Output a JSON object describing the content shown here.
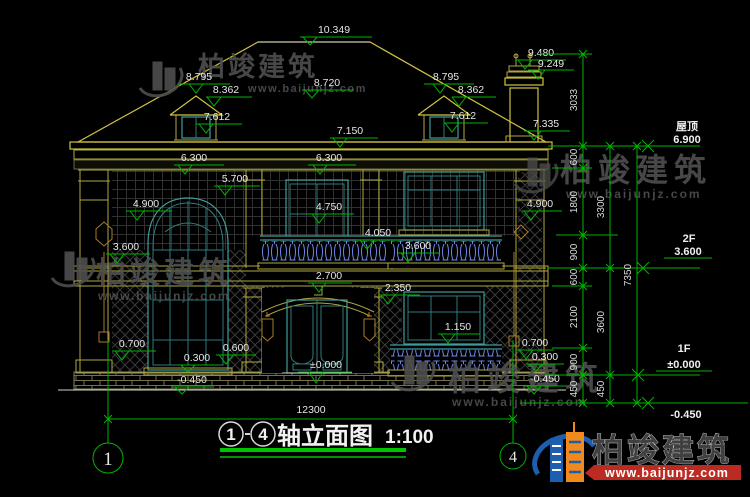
{
  "drawing": {
    "title": "轴立面图",
    "scale": "1:100",
    "axis_start": "1",
    "axis_end": "4"
  },
  "levels": {
    "roof_label": "屋顶",
    "roof_value": "6.900",
    "f2_label": "2F",
    "f2_value": "3.600",
    "f1_label": "1F",
    "f1_value": "±0.000",
    "below_ground": "-0.450"
  },
  "dims": {
    "roof_ridge": "10.349",
    "roof_mid": "8.720",
    "dormer_l_top": "8.795",
    "dormer_l_eave": "8.362",
    "dormer_l_sill": "7.612",
    "dormer_r_top": "8.795",
    "dormer_r_eave": "8.362",
    "dormer_r_sill": "7.612",
    "eave_mid": "7.150",
    "chimney_top": "9.480",
    "chimney_cap": "9.249",
    "chimney_eave": "7.335",
    "band_left": "6.300",
    "band_right": "6.300",
    "arch_top": "5.700",
    "left_head": "4.900",
    "right_head": "4.900",
    "f2_sill": "4.750",
    "balcony_rail": "4.050",
    "balcony_floor": "3.600",
    "left_transom": "3.600",
    "entry_arch": "2.700",
    "f1_head": "2.350",
    "f1_sill": "1.150",
    "left_sill": "0.700",
    "left_base": "0.600",
    "left_step": "0.300",
    "left_ground": "-0.450",
    "door_zero": "±0.000",
    "right_sill": "0.700",
    "right_step": "0.300",
    "right_ground": "-0.450",
    "total_width": "12300"
  },
  "chains": {
    "c3033": "3033",
    "c600a": "600",
    "c1800": "1800",
    "c900a": "900",
    "c600b": "600",
    "c2100": "2100",
    "c900b": "900",
    "c450a": "450",
    "c3300": "3300",
    "c3600": "3600",
    "c450b": "450",
    "c7350": "7350"
  },
  "watermark": {
    "brand": "柏竣建筑",
    "url": "www.baijunjz.com"
  },
  "logo": {
    "brand": "柏竣建筑",
    "url": "www.baijunjz.com"
  }
}
